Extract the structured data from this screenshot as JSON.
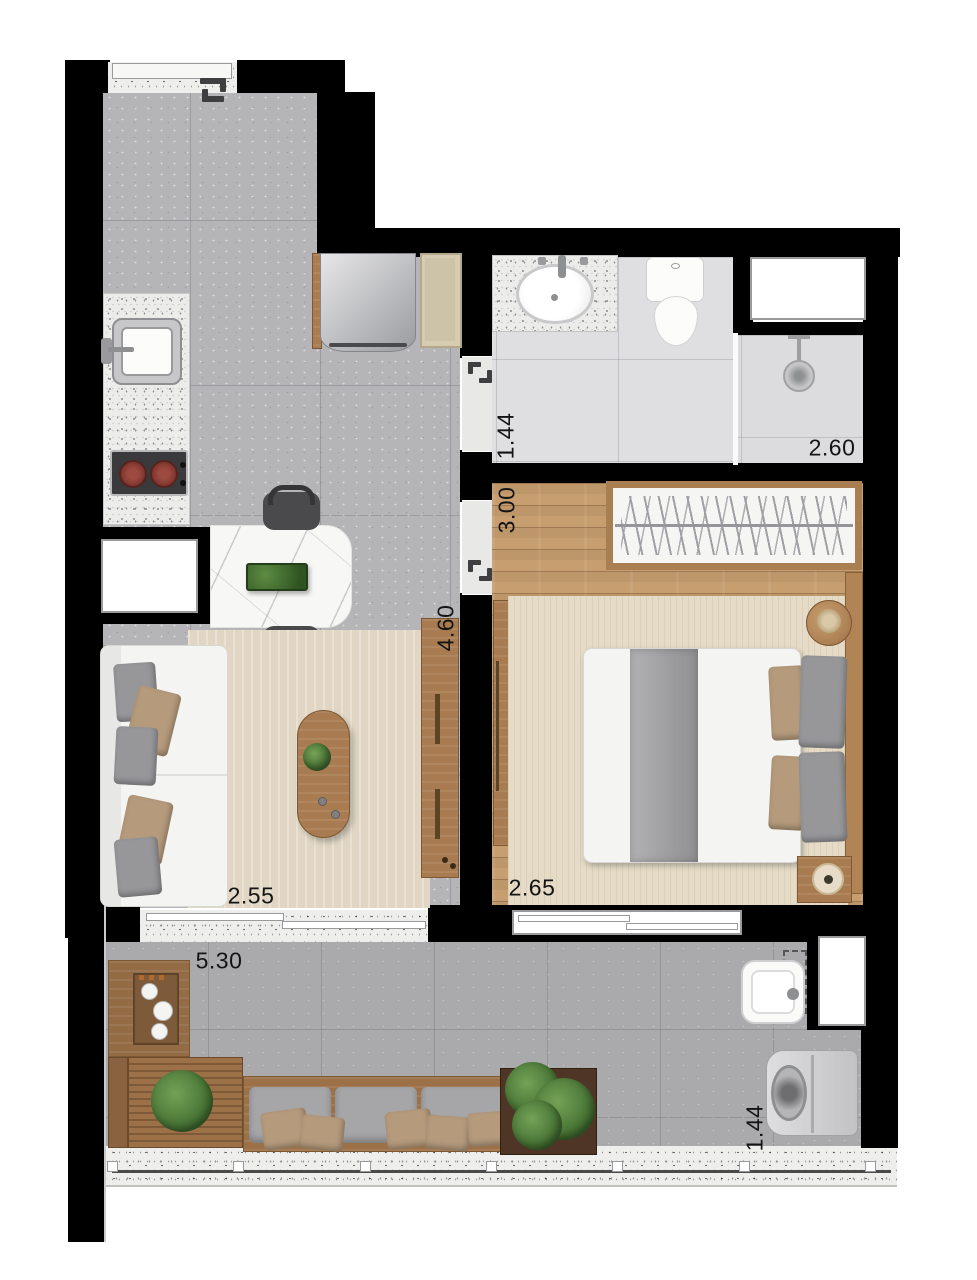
{
  "dimensions": {
    "bathroom_width": "1.44",
    "shower_width": "2.60",
    "bedroom_length": "3.00",
    "hall_length": "4.60",
    "living_width": "2.55",
    "bedroom_width": "2.65",
    "balcony_length": "5.30",
    "service_width": "1.44"
  },
  "colors": {
    "wall": "#000000",
    "kitchen_floor": "#b5b5b7",
    "bathroom_floor": "#dfdfe1",
    "bedroom_floor": "#c79e70",
    "balcony_floor": "#aaaaac",
    "rug": "#e0d6c3",
    "terrazzo": "#eeeeec",
    "wood": "#a87c50",
    "greenery": "#3f6b2e",
    "burner": "#7e352d",
    "label_text": "#141414"
  }
}
